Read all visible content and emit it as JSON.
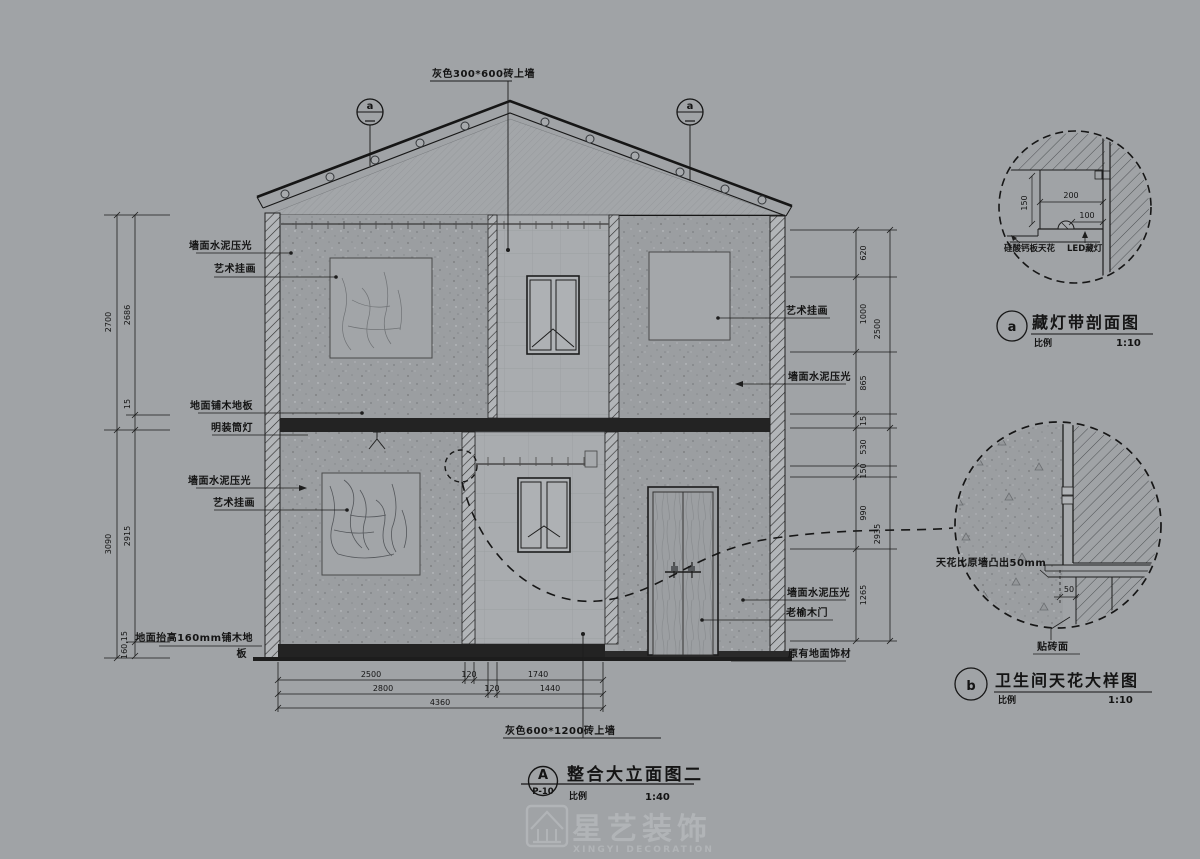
{
  "drawing": {
    "top_label": "灰色300*600砖上墙",
    "bottom_label": "灰色600*1200砖上墙",
    "section_marker": "a",
    "left_labels": {
      "wall_cement_upper": "墙面水泥压光",
      "art_upper": "艺术挂画",
      "wood_floor": "地面铺木地板",
      "downlight": "明装筒灯",
      "wall_cement_lower": "墙面水泥压光",
      "art_lower": "艺术挂画",
      "raised_floor_line1": "地面抬高160mm铺木地",
      "raised_floor_line2": "板"
    },
    "right_labels": {
      "art": "艺术挂画",
      "wall_cement_upper": "墙面水泥压光",
      "wall_cement_lower": "墙面水泥压光",
      "door": "老榆木门",
      "orig_floor": "原有地面饰材"
    },
    "dims": {
      "left_outer": [
        "2700",
        "3090"
      ],
      "left_inner": [
        "2686",
        "15",
        "2915",
        "160,15"
      ],
      "right_outer": [
        "2500",
        "2935"
      ],
      "right_inner": [
        "620",
        "1000",
        "865",
        "15",
        "530",
        "150",
        "990",
        "1265"
      ],
      "bottom_row1": [
        "2500",
        "120",
        "1740"
      ],
      "bottom_row2": [
        "2800",
        "120",
        "1440"
      ],
      "bottom_row3": "4360"
    }
  },
  "detail_a": {
    "marker": "a",
    "title": "藏灯带剖面图",
    "scale_label": "比例",
    "scale_value": "1:10",
    "dims": {
      "d200": "200",
      "d100": "100",
      "d150": "150"
    },
    "labels": {
      "ceiling": "硅酸钙板天花",
      "led": "LED藏灯"
    }
  },
  "detail_b": {
    "marker": "b",
    "title": "卫生间天花大样图",
    "scale_label": "比例",
    "scale_value": "1:10",
    "labels": {
      "bump": "天花比原墙凸出50mm",
      "d50": "50",
      "tile": "贴砖面"
    }
  },
  "title_block": {
    "marker": "A",
    "sheet": "P-10",
    "title": "整合大立面图二",
    "scale_label": "比例",
    "scale_value": "1:40"
  },
  "logo": {
    "name": "星艺装饰",
    "sub": "XINGYI DECORATION"
  },
  "colors": {
    "background": "#a0a3a6",
    "line": "#1d1d1d",
    "slab": "#232323",
    "watermark": "#b1b4b7"
  }
}
